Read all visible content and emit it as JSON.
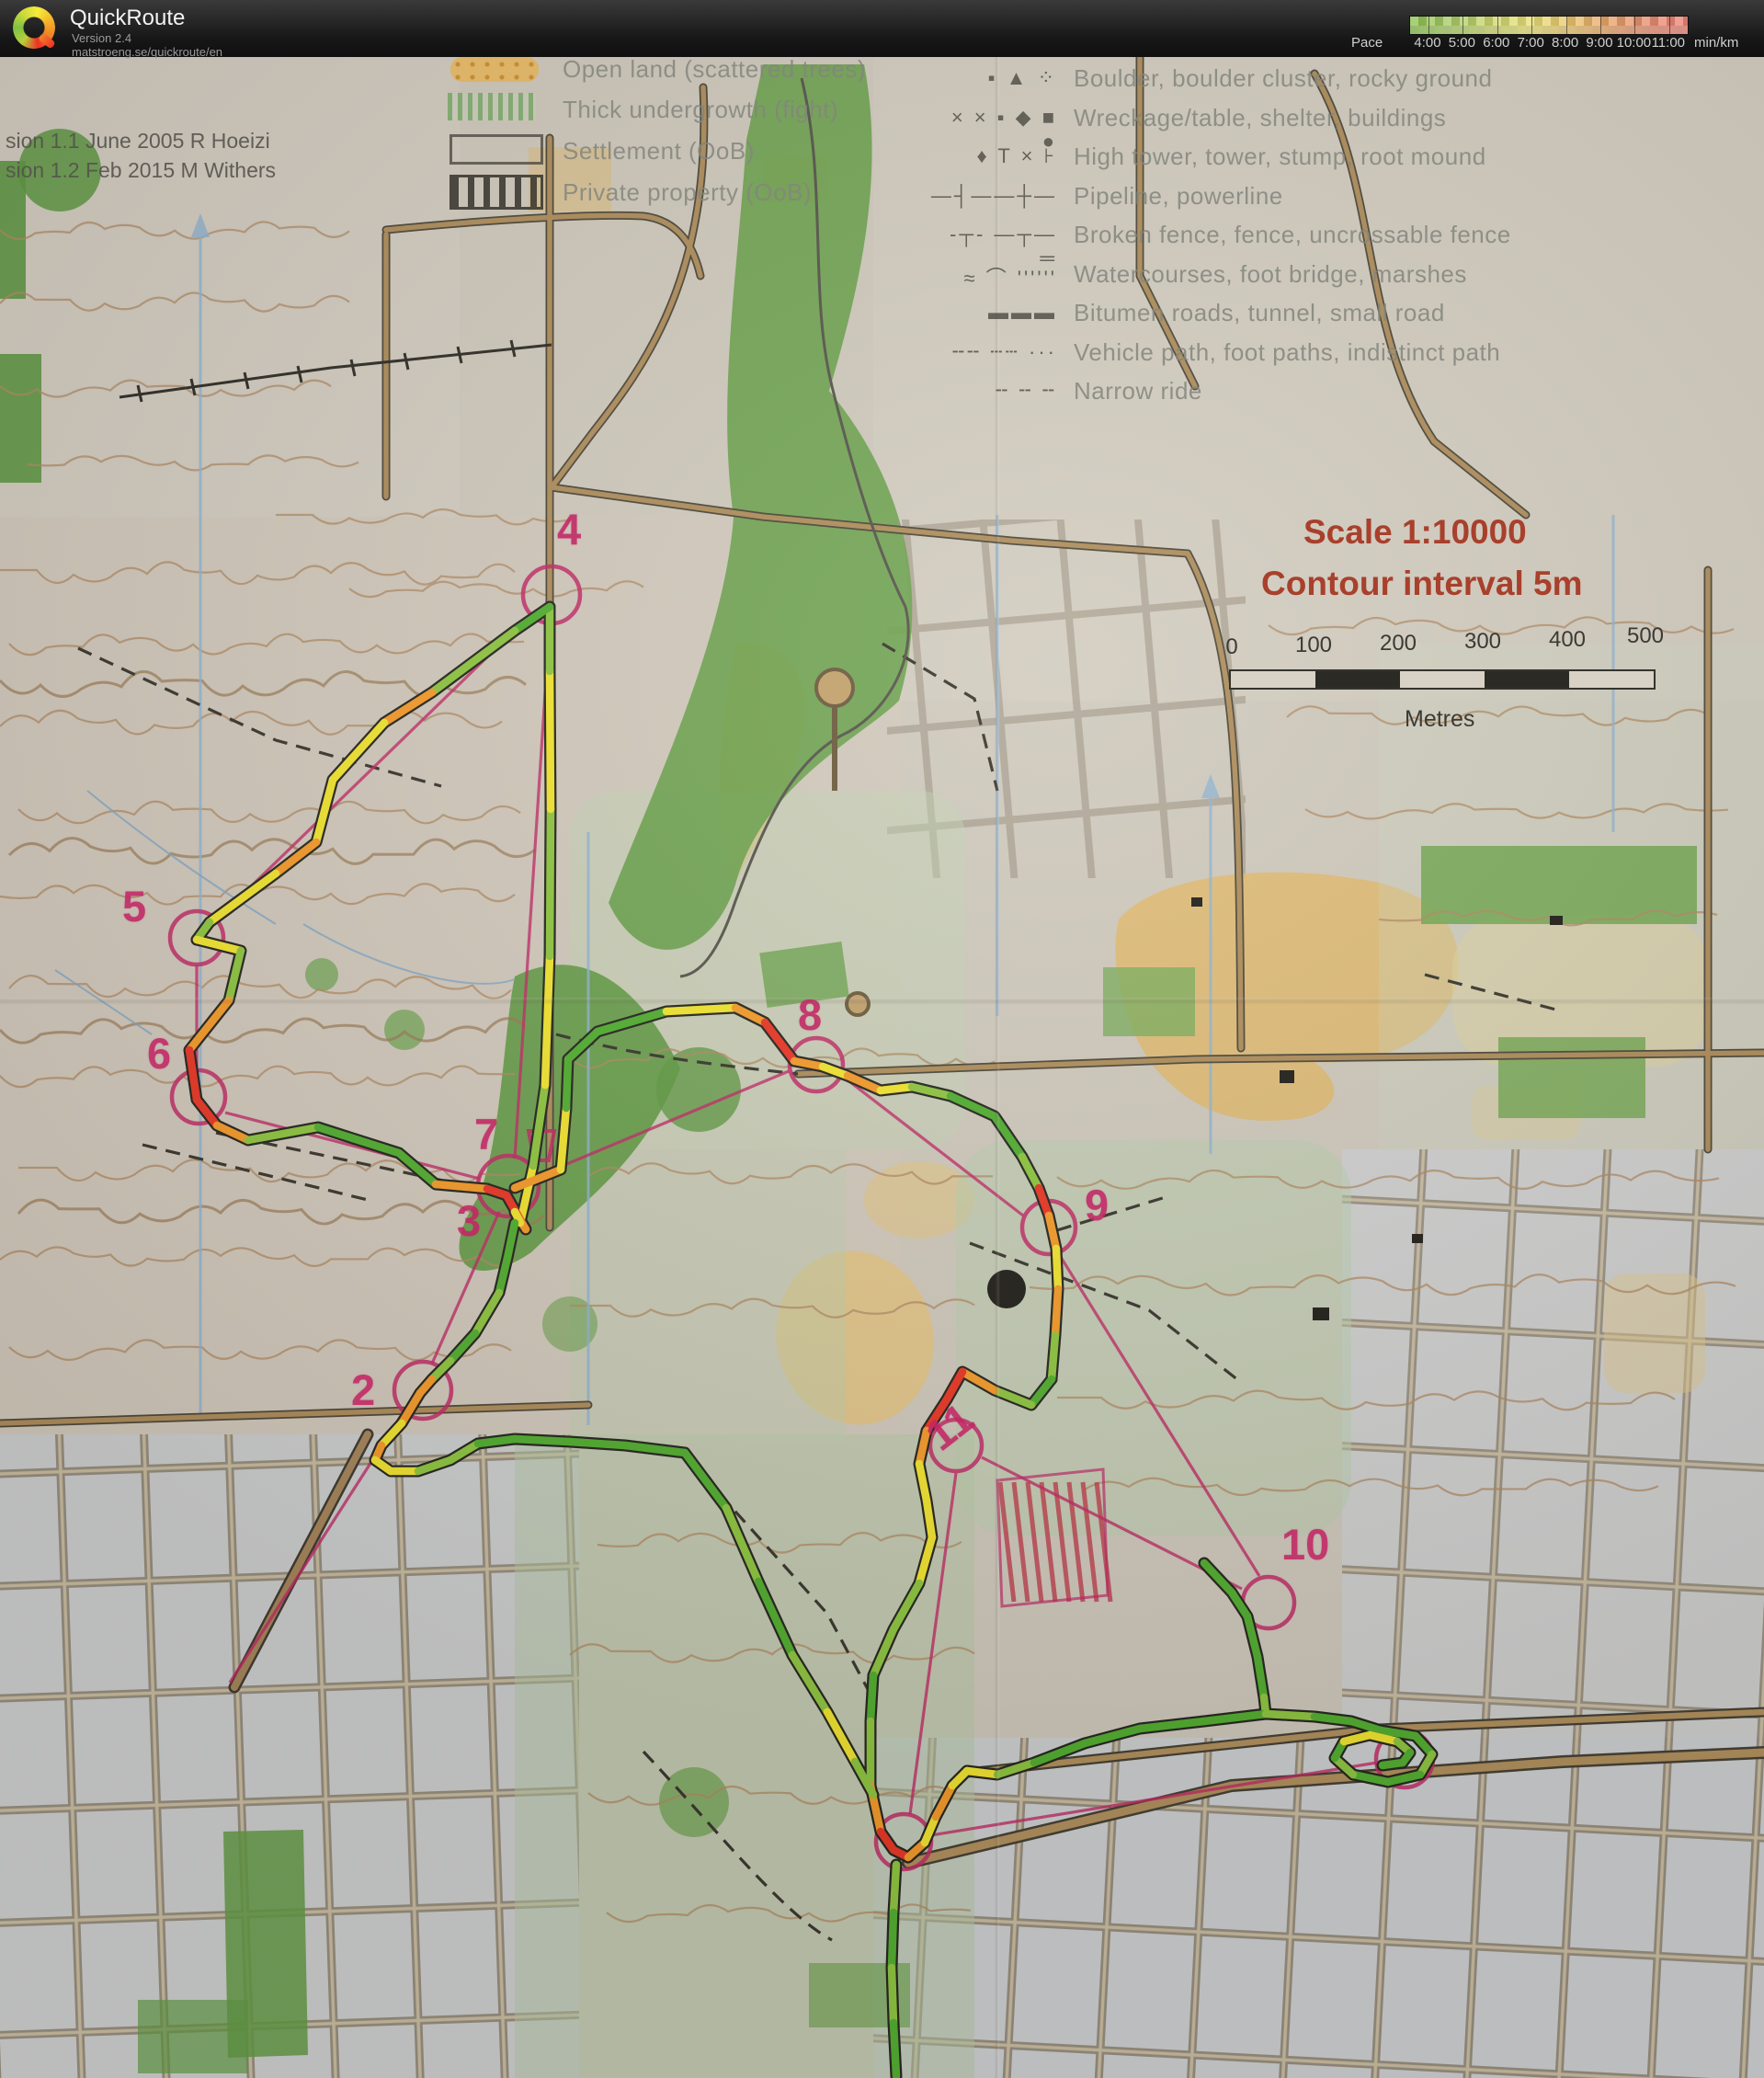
{
  "header": {
    "app_name": "QuickRoute",
    "version": "Version 2.4",
    "url": "matstroeng.se/quickroute/en",
    "pace_label": "Pace",
    "pace_unit": "min/km",
    "pace_ticks": [
      "4:00",
      "5:00",
      "6:00",
      "7:00",
      "8:00",
      "9:00",
      "10:00",
      "11:00"
    ],
    "pace_colors": {
      "fast": "#8cc24f",
      "medium": "#e8e077",
      "slow": "#ec8177"
    }
  },
  "map": {
    "revision_lines": [
      "sion 1.1 June 2005 R Hoeizi",
      "sion 1.2 Feb 2015 M Withers"
    ],
    "legend_left": [
      {
        "label": "Open land (scattered trees)"
      },
      {
        "label": "Thick undergrowth (fight)"
      },
      {
        "label": "Settlement (OoB)"
      },
      {
        "label": "Private property (OoB)"
      }
    ],
    "legend_right_symbols": [
      "▪ ▲ ⁘",
      "× × ▪ ◆ ■ ●",
      "♦ T × ⊦",
      "—┤——┼—",
      "-┬- —┬— ═",
      "≈ ⌒ ''''''",
      "▬▬▬",
      "╌╌ ┄┄ ···",
      "╌ ╌ ╌"
    ],
    "legend_right": [
      "Boulder, boulder cluster, rocky ground",
      "Wreckage/table, shelter, buildings",
      "High tower, tower, stump, root mound",
      "Pipeline, powerline",
      "Broken fence, fence, uncrossable fence",
      "Watercourses, foot bridge, marshes",
      "Bitumen roads, tunnel, small road",
      "Vehicle path, foot paths, indistinct path",
      "Narrow ride"
    ],
    "scale_title": "Scale 1:10000",
    "contour_title": "Contour interval 5m",
    "scale_bar": {
      "ticks": [
        "0",
        "100",
        "200",
        "300",
        "400",
        "500"
      ],
      "unit": "Metres"
    },
    "controls": [
      "2",
      "3",
      "4",
      "5",
      "6",
      "7",
      "8",
      "9",
      "10",
      "11"
    ],
    "course_color": "#c22765",
    "route_pace_colors": [
      "#4fae2e",
      "#8dc63f",
      "#f2e52e",
      "#f59a28",
      "#ea3423"
    ]
  }
}
